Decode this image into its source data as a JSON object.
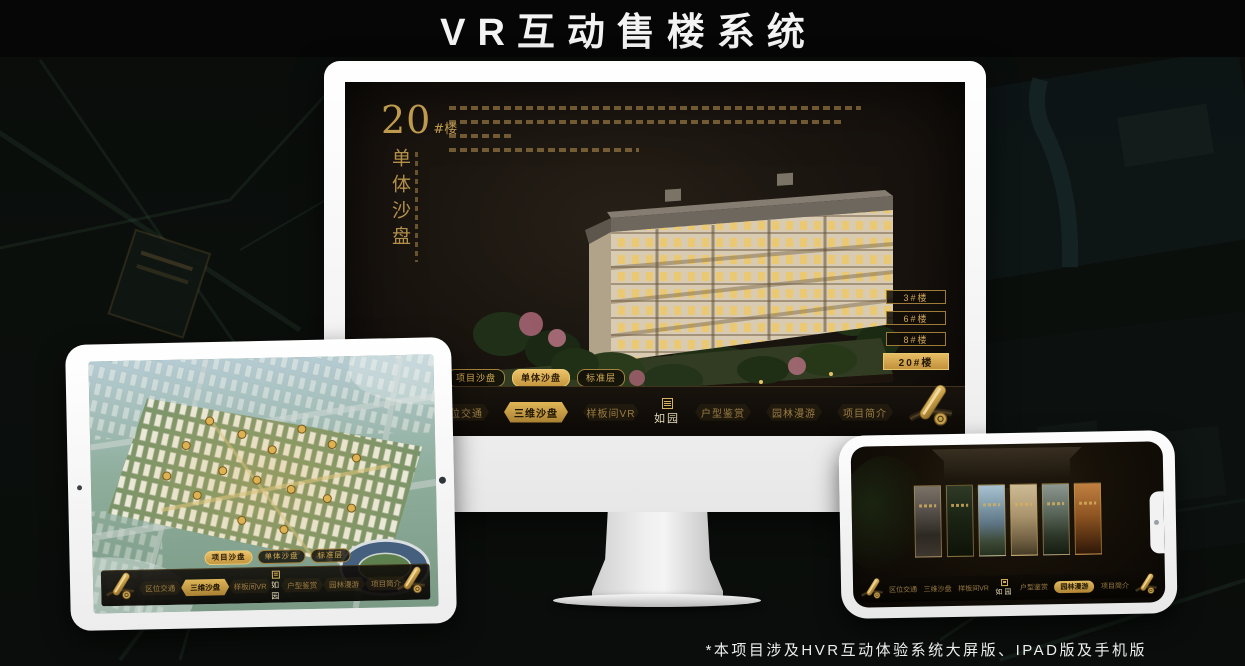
{
  "page": {
    "title": "VR互动售楼系统",
    "footnote": "*本项目涉及HVR互动体验系统大屏版、IPAD版及手机版"
  },
  "colors": {
    "gold": "#c9a35a",
    "gold_bright": "#e7bd63",
    "screen_bg": "#1b1510",
    "title_bg": "#060606"
  },
  "monitor": {
    "heading": {
      "number": "20",
      "suffix": "#楼",
      "vertical": "单体沙盘"
    },
    "tabs": [
      {
        "label": "项目沙盘",
        "active": false
      },
      {
        "label": "单体沙盘",
        "active": true
      },
      {
        "label": "标准层",
        "active": false
      }
    ],
    "building_buttons": [
      {
        "label": "3#楼",
        "active": false
      },
      {
        "label": "6#楼",
        "active": false
      },
      {
        "label": "8#楼",
        "active": false
      },
      {
        "label": "20#楼",
        "active": true
      }
    ],
    "nav": {
      "logo": "如园",
      "items": [
        {
          "label": "区位交通",
          "active": false
        },
        {
          "label": "三维沙盘",
          "active": true
        },
        {
          "label": "样板间VR",
          "active": false
        },
        {
          "label": "户型鉴赏",
          "active": false
        },
        {
          "label": "园林漫游",
          "active": false
        },
        {
          "label": "项目简介",
          "active": false
        }
      ]
    }
  },
  "tablet": {
    "tabs": [
      {
        "label": "项目沙盘",
        "active": true
      },
      {
        "label": "单体沙盘",
        "active": false
      },
      {
        "label": "标准层",
        "active": false
      }
    ],
    "nav": {
      "logo": "如园",
      "items": [
        {
          "label": "区位交通",
          "active": false
        },
        {
          "label": "三维沙盘",
          "active": true
        },
        {
          "label": "样板间VR",
          "active": false
        },
        {
          "label": "户型鉴赏",
          "active": false
        },
        {
          "label": "园林漫游",
          "active": false
        },
        {
          "label": "项目简介",
          "active": false
        }
      ]
    }
  },
  "phone": {
    "nav": {
      "logo": "如园",
      "items": [
        {
          "label": "区位交通",
          "active": false
        },
        {
          "label": "三维沙盘",
          "active": false
        },
        {
          "label": "样板间VR",
          "active": false
        },
        {
          "label": "户型鉴赏",
          "active": false
        },
        {
          "label": "园林漫游",
          "active": true
        },
        {
          "label": "项目简介",
          "active": false
        }
      ]
    }
  }
}
